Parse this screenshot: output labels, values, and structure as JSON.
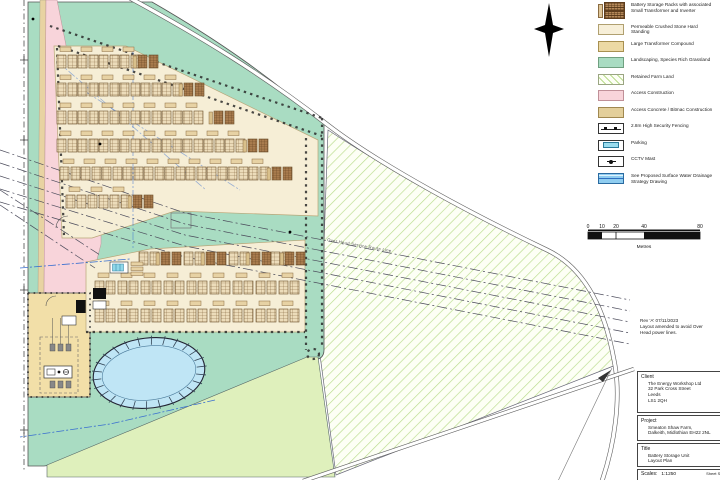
{
  "legend": {
    "items": [
      {
        "id": "battery-racks",
        "swatch": "racks",
        "label": "Battery Storage Racks with associated Small Transformer and Inverter"
      },
      {
        "id": "hard-standing",
        "swatch": "cream",
        "label": "Permeable Crushed Stone Hard Standing"
      },
      {
        "id": "transformer-compound",
        "swatch": "tan",
        "label": "Large Transformer Compound"
      },
      {
        "id": "landscaping",
        "swatch": "green",
        "label": "Landscaping, Species Rich Grassland"
      },
      {
        "id": "farm-land",
        "swatch": "hatch",
        "label": "Retained Farm Land"
      },
      {
        "id": "access-construction",
        "swatch": "pink",
        "label": "Access Construction"
      },
      {
        "id": "access-concrete",
        "swatch": "darktan",
        "label": "Access Concrete / Bitmac Construction"
      },
      {
        "id": "security-fencing",
        "swatch": "fence",
        "label": "2.8m High Security Fencing",
        "sublabel": "located on drg 25/26"
      },
      {
        "id": "parking",
        "swatch": "parking",
        "label": "Parking"
      },
      {
        "id": "cctv",
        "swatch": "cctv",
        "label": "CCTV Mast"
      },
      {
        "id": "drainage",
        "swatch": "drainage",
        "label": "See Proposed Surface Water Drainage Strategy Drawing"
      }
    ]
  },
  "scalebar": {
    "ticks": [
      "0",
      "10",
      "20",
      "40",
      "80"
    ],
    "unit": "Metres"
  },
  "revision": [
    "Rev 'A' 07/11/2023",
    "Layout amended to avoid Over",
    "Head power lines."
  ],
  "title_block": {
    "client_label": "Client",
    "client_lines": [
      "The Energy Workshop Ltd",
      "32 Park Cross Street",
      "Leeds",
      "LS1 2QH"
    ],
    "project_label": "Project",
    "project_lines": [
      "Smeaton Shaw Farm,",
      "Dalkeith, Midlothian EH22 2NL"
    ],
    "title_label": "Title",
    "title_lines": [
      "Battery Storage Unit",
      "Layout Plan"
    ],
    "scales_label": "Scales:",
    "scales_value": "1:1250",
    "sheet_text": "Sheet Size A"
  },
  "plan": {
    "annotation": "Over Head Service Route Line",
    "colors": {
      "landscaping": "#a9dcc2",
      "hard_standing": "#f6eed6",
      "farmland_bg": "#fdfff5",
      "farmland_hatch": "#b9dc8c",
      "field": "#dff0bc",
      "pink": "#f8d4da",
      "tan_strip": "#e8d3a2",
      "compound": "#f2dfa8",
      "pond": "#bfe5f5",
      "rack_fill": "#ecdcba",
      "rack_dark": "#a97c4e",
      "road": "#5e5e5e",
      "ohl": "#4a4a5a",
      "drain": "#3a6fd0"
    },
    "upper_rows": [
      {
        "y": 55,
        "plain": [
          57,
          78,
          99,
          120
        ],
        "hatched": [
          138
        ]
      },
      {
        "y": 83,
        "plain": [
          57,
          78,
          99,
          120,
          141,
          162
        ],
        "hatched": [
          184
        ]
      },
      {
        "y": 111,
        "plain": [
          57,
          78,
          99,
          120,
          141,
          162,
          183
        ],
        "hatched": [
          214
        ]
      },
      {
        "y": 139,
        "plain": [
          57,
          78,
          99,
          120,
          141,
          162,
          183,
          204,
          225
        ],
        "hatched": [
          248
        ]
      },
      {
        "y": 167,
        "plain": [
          60,
          81,
          102,
          123,
          144,
          165,
          186,
          207,
          228,
          249
        ],
        "hatched": [
          272
        ]
      },
      {
        "y": 195,
        "plain": [
          66,
          88,
          110
        ],
        "hatched": [
          133
        ]
      }
    ],
    "lower_rows": [
      {
        "y": 252,
        "plain": [
          139,
          184,
          229,
          271
        ],
        "hatched": [
          161,
          206,
          251,
          285
        ],
        "tx": false
      },
      {
        "y": 281,
        "plain": [
          95,
          118,
          141,
          164,
          187,
          210,
          233,
          256,
          279
        ],
        "hatched": [],
        "tx": true
      },
      {
        "y": 309,
        "plain": [
          95,
          118,
          141,
          164,
          187,
          210,
          233,
          256,
          279
        ],
        "hatched": [],
        "tx": true
      }
    ]
  }
}
